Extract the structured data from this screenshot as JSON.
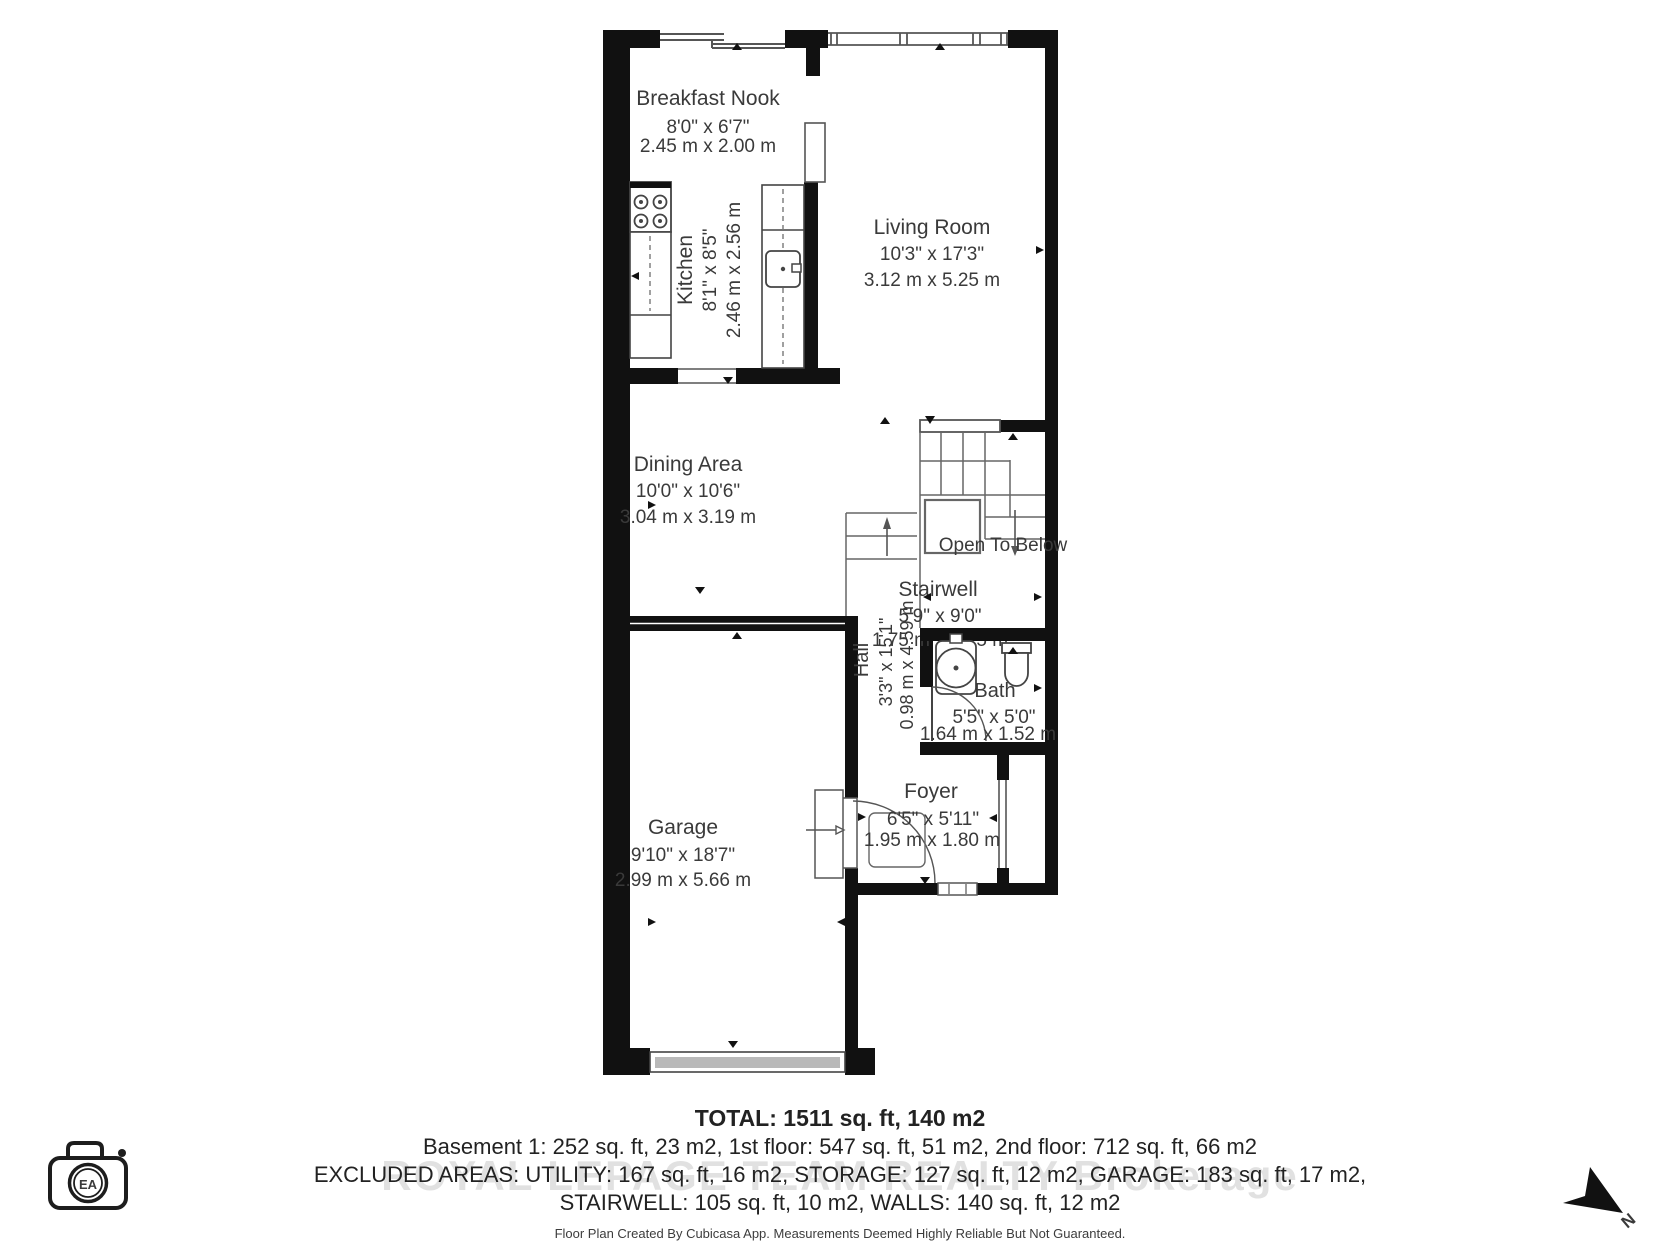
{
  "floor_plan": {
    "rooms": [
      {
        "name": "Breakfast Nook",
        "imperial": "8'0\" x 6'7\"",
        "metric": "2.45 m x 2.00 m"
      },
      {
        "name": "Kitchen",
        "imperial": "8'1\" x 8'5\"",
        "metric": "2.46 m x 2.56 m"
      },
      {
        "name": "Living Room",
        "imperial": "10'3\" x 17'3\"",
        "metric": "3.12 m x 5.25 m"
      },
      {
        "name": "Dining Area",
        "imperial": "10'0\" x 10'6\"",
        "metric": "3.04 m x 3.19 m"
      },
      {
        "name": "Stairwell",
        "imperial": "5'9\" x 9'0\"",
        "metric": "1.75 m x 2.75 m"
      },
      {
        "name": "Hall",
        "imperial": "3'3\" x 15'1\"",
        "metric": "0.98 m x 4.59 m"
      },
      {
        "name": "Bath",
        "imperial": "5'5\" x 5'0\"",
        "metric": "1.64 m x 1.52 m"
      },
      {
        "name": "Garage",
        "imperial": "9'10\" x 18'7\"",
        "metric": "2.99 m x 5.66 m"
      },
      {
        "name": "Foyer",
        "imperial": "6'5\" x 5'11\"",
        "metric": "1.95 m x 1.80 m"
      }
    ],
    "annotations": {
      "open_to_below": "Open To Below"
    },
    "summary": {
      "total": "TOTAL: 1511 sq. ft, 140 m2",
      "floors": "Basement 1: 252 sq. ft, 23 m2, 1st floor: 547 sq. ft, 51 m2, 2nd floor: 712 sq. ft, 66 m2",
      "excluded_1": "EXCLUDED AREAS: UTILITY: 167 sq. ft, 16 m2, STORAGE: 127 sq. ft, 12 m2, GARAGE: 183 sq. ft, 17 m2,",
      "excluded_2": "STAIRWELL: 105 sq. ft, 10 m2, WALLS: 140 sq. ft, 12 m2",
      "disclaimer": "Floor Plan Created By Cubicasa App. Measurements Deemed Highly Reliable But Not Guaranteed."
    },
    "watermark": "ROYAL LEPAGE TEAM REALTY Brokerage",
    "logo_text": "EA",
    "compass_label": "N",
    "icons": {
      "stove": "stove-icon",
      "sink": "sink-icon",
      "toilet": "toilet-icon",
      "stairs": "stairs-icon",
      "camera": "ea-camera-logo",
      "north": "north-arrow-icon"
    },
    "colors": {
      "wall": "#111111",
      "line": "#555555",
      "fixture": "#444444",
      "text": "#3a3a3a"
    }
  }
}
